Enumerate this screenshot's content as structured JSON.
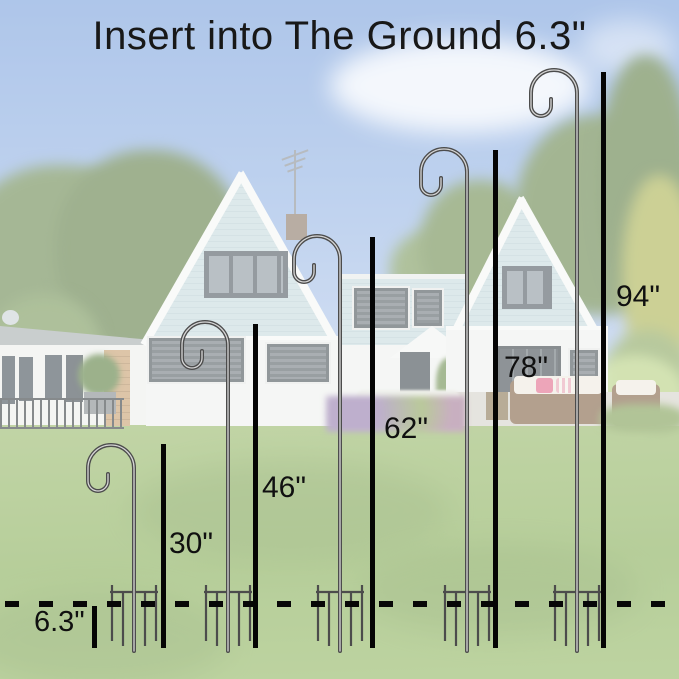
{
  "title": "Insert into The Ground 6.3\"",
  "diagram": {
    "type": "measurement-diagram",
    "unit": "inches",
    "hook_heights_in": [
      30,
      46,
      62,
      78,
      94
    ],
    "insert_depth_in": 6.3
  },
  "hooks": [
    {
      "height_in": 30,
      "label": "30\"",
      "pole_x": 134,
      "apex_y": 445,
      "line_x": 161,
      "line_top": 444,
      "label_x": 169,
      "label_y": 527
    },
    {
      "height_in": 46,
      "label": "46\"",
      "pole_x": 228,
      "apex_y": 322,
      "line_x": 253,
      "line_top": 324,
      "label_x": 262,
      "label_y": 471
    },
    {
      "height_in": 62,
      "label": "62\"",
      "pole_x": 340,
      "apex_y": 236,
      "line_x": 370,
      "line_top": 237,
      "label_x": 384,
      "label_y": 412
    },
    {
      "height_in": 78,
      "label": "78\"",
      "pole_x": 467,
      "apex_y": 149,
      "line_x": 493,
      "line_top": 150,
      "label_x": 504,
      "label_y": 351
    },
    {
      "height_in": 94,
      "label": "94\"",
      "pole_x": 577,
      "apex_y": 70,
      "line_x": 601,
      "line_top": 72,
      "label_x": 616,
      "label_y": 280
    }
  ],
  "ground": {
    "depth_label": "6.3\"",
    "line_bottom_y": 648
  },
  "colors": {
    "annotation_black": "#050505",
    "hook_metal": "#4c4c4c",
    "hook_highlight": "#d6d6d6",
    "sky": "#7da3dd",
    "grass": "#8ab05c",
    "siding": "#c9dbdf"
  }
}
